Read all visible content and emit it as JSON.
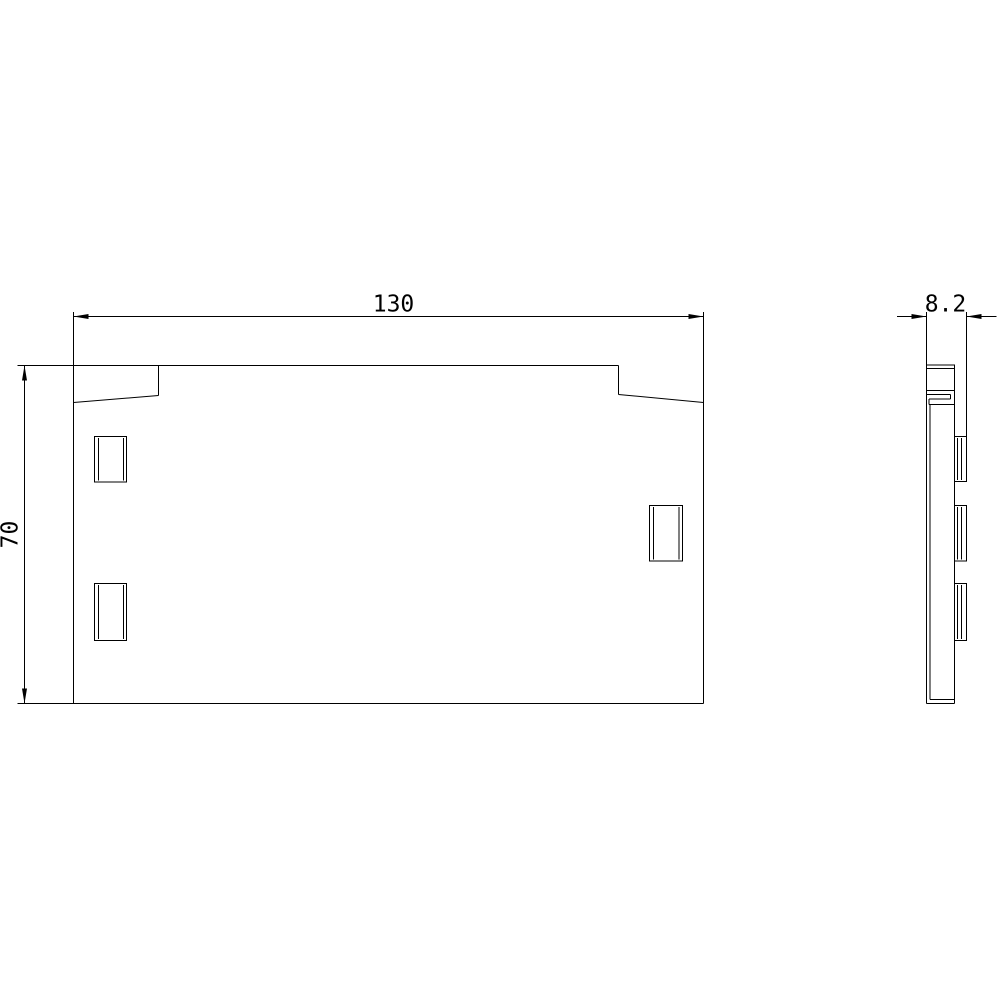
{
  "canvas": {
    "background": "#ffffff",
    "line_color": "#000000"
  },
  "drawing": {
    "kind": "two-view dimensional technical drawing of a flat cover plate",
    "views": [
      {
        "name": "front view"
      },
      {
        "name": "side view"
      }
    ],
    "dimensions": [
      {
        "id": "width",
        "label": "130",
        "view": "front view",
        "orientation": "horizontal"
      },
      {
        "id": "height",
        "label": "70",
        "view": "front view",
        "orientation": "vertical"
      },
      {
        "id": "depth",
        "label": "8.2",
        "view": "side view",
        "orientation": "horizontal"
      }
    ]
  }
}
